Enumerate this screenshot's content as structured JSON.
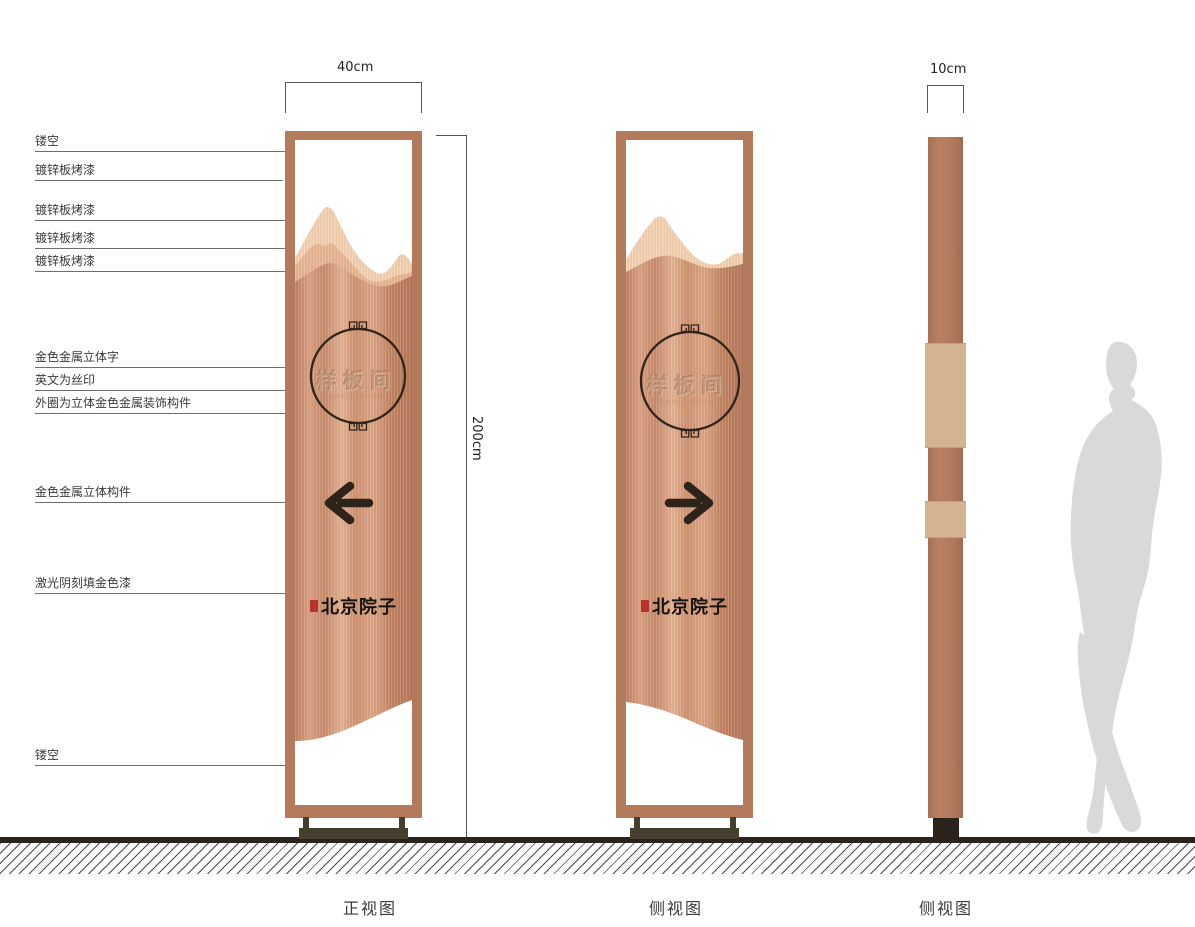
{
  "drawing": {
    "callouts": [
      "镂空",
      "镀锌板烤漆",
      "镀锌板烤漆",
      "镀锌板烤漆",
      "镀锌板烤漆",
      "金色金属立体字",
      "英文为丝印",
      "外圈为立体金色金属装饰构件",
      "金色金属立体构件",
      "激光阴刻填金色漆",
      "镂空"
    ],
    "dimensions": {
      "front_width": "40cm",
      "total_height": "200cm",
      "side_depth": "10cm"
    },
    "views": {
      "front": {
        "caption": "正视图",
        "room_name": "样板间",
        "room_name_en": "SAMPLE ROOM",
        "brand": "北京院子",
        "arrow_direction": "left"
      },
      "back": {
        "caption": "侧视图",
        "room_name": "样板间",
        "room_name_en": "SAMPLE ROOM",
        "brand": "北京院子",
        "arrow_direction": "right"
      },
      "profile": {
        "caption": "侧视图"
      }
    },
    "colors": {
      "copper_frame": "#b47a5c",
      "panel_light": "#f2d0b2",
      "panel_mid": "#e6b692",
      "accent_dark": "#30251b",
      "seal_red": "#b5332a",
      "stand": "#45402e",
      "ground": "#2a241d",
      "silhouette": "#d9d9d9"
    }
  }
}
